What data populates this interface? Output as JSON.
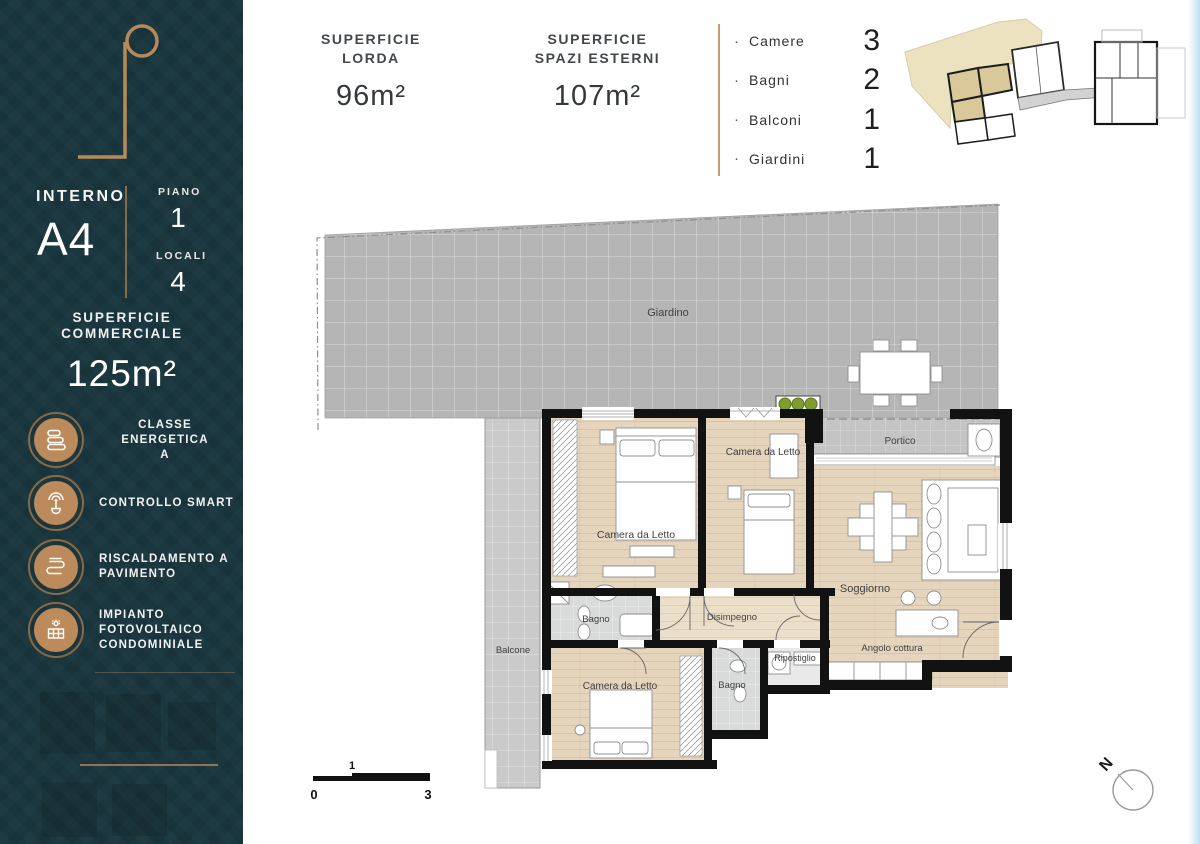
{
  "colors": {
    "sidebar_bg": "#1a363e",
    "accent": "#bd8a5b",
    "accent_dark": "#8a6a45",
    "divider": "#cf9a6a",
    "text_dark": "#43474a",
    "wall": "#121212",
    "plant": "#7f9c2e",
    "garden_gray": "#b4b5b4",
    "floor_beige": "#e6d5bd",
    "keyplan_highlight": "#d9c89a"
  },
  "sidebar": {
    "interno_label": "INTERNO",
    "interno_value": "A4",
    "piano_label": "PIANO",
    "piano_value": "1",
    "locali_label": "LOCALI",
    "locali_value": "4",
    "superficie": {
      "line1": "SUPERFICIE",
      "line2": "COMMERCIALE",
      "value": "125m²"
    },
    "features": [
      {
        "icon": "energy-class-icon",
        "line1": "CLASSE ENERGETICA",
        "line2": "A"
      },
      {
        "icon": "smart-control-icon",
        "line1": "CONTROLLO SMART",
        "line2": ""
      },
      {
        "icon": "floor-heating-icon",
        "line1": "RISCALDAMENTO A",
        "line2": "PAVIMENTO"
      },
      {
        "icon": "photovoltaic-icon",
        "line1": "IMPIANTO",
        "line2": "FOTOVOLTAICO",
        "line3": "CONDOMINIALE"
      }
    ]
  },
  "header": {
    "gross": {
      "line1": "SUPERFICIE",
      "line2": "LORDA",
      "value": "96m²"
    },
    "external": {
      "line1": "SUPERFICIE",
      "line2": "SPAZI ESTERNI",
      "value": "107m²"
    }
  },
  "stats": {
    "bullet": "·",
    "items": [
      {
        "label": "Camere",
        "value": "3"
      },
      {
        "label": "Bagni",
        "value": "2"
      },
      {
        "label": "Balconi",
        "value": "1"
      },
      {
        "label": "Giardini",
        "value": "1"
      }
    ]
  },
  "plan": {
    "labels": {
      "giardino": "Giardino",
      "portico": "Portico",
      "soggiorno": "Soggiorno",
      "angolo_cottura": "Angolo cottura",
      "disimpegno": "Disimpegno",
      "bagno1": "Bagno",
      "bagno2": "Bagno",
      "camera1": "Camera da Letto",
      "camera2": "Camera da Letto",
      "camera3": "Camera da Letto",
      "ripostiglio": "Ripostiglio",
      "balcone": "Balcone"
    },
    "scale": {
      "zero": "0",
      "one": "1",
      "three": "3"
    },
    "compass": "N"
  }
}
